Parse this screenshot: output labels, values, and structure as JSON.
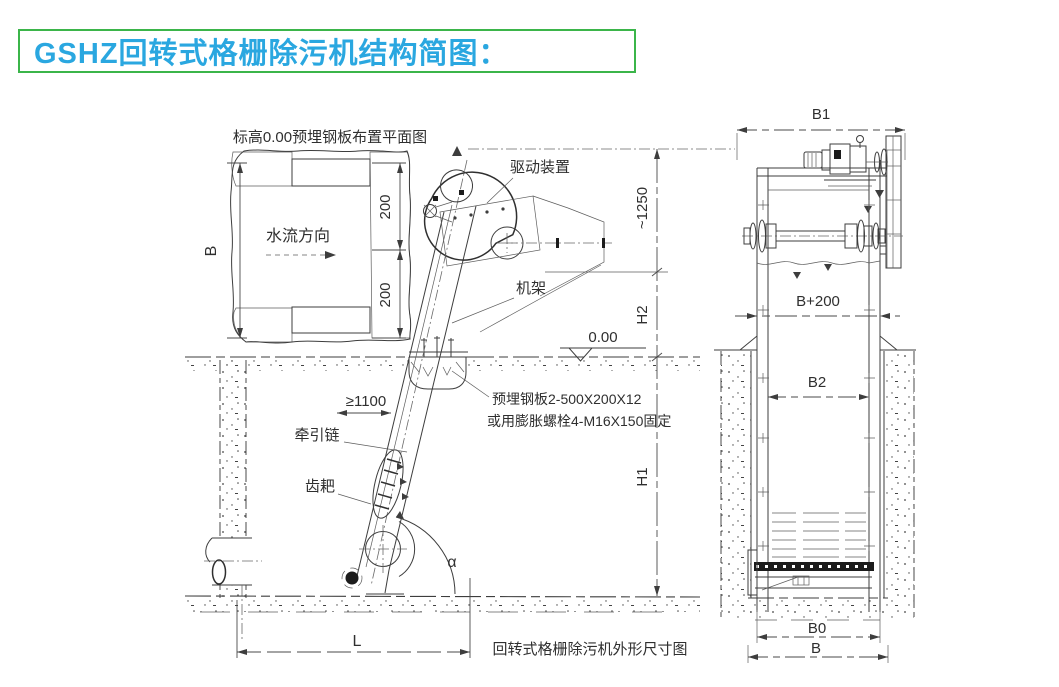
{
  "title": {
    "text": "GSHZ回转式格栅除污机结构简图：",
    "text_color": "#2aa7e0",
    "border_color": "#3bb54a"
  },
  "plan_view": {
    "title": "标高0.00预埋钢板布置平面图",
    "flow_direction": "水流方向",
    "dim_width": "B",
    "dim_offset_top": "200",
    "dim_offset_bottom": "200"
  },
  "side_view": {
    "drive_unit_label": "驱动装置",
    "frame_label": "机架",
    "elevation_label": "0.00",
    "dim_top_height": "~1250",
    "dim_h2": "H2",
    "dim_h1": "H1",
    "dim_clearance": "≥1100",
    "traction_chain_label": "牵引链",
    "rake_label": "齿耙",
    "plate_note_line1": "预埋钢板2-500X200X12",
    "plate_note_line2": "或用膨胀螺栓4-M16X150固定",
    "angle_label": "α",
    "dim_length": "L",
    "caption": "回转式格栅除污机外形尺寸图"
  },
  "front_view": {
    "dim_b1": "B1",
    "dim_b_plus_200": "B+200",
    "dim_b2": "B2",
    "dim_b0": "B0",
    "dim_b": "B"
  }
}
